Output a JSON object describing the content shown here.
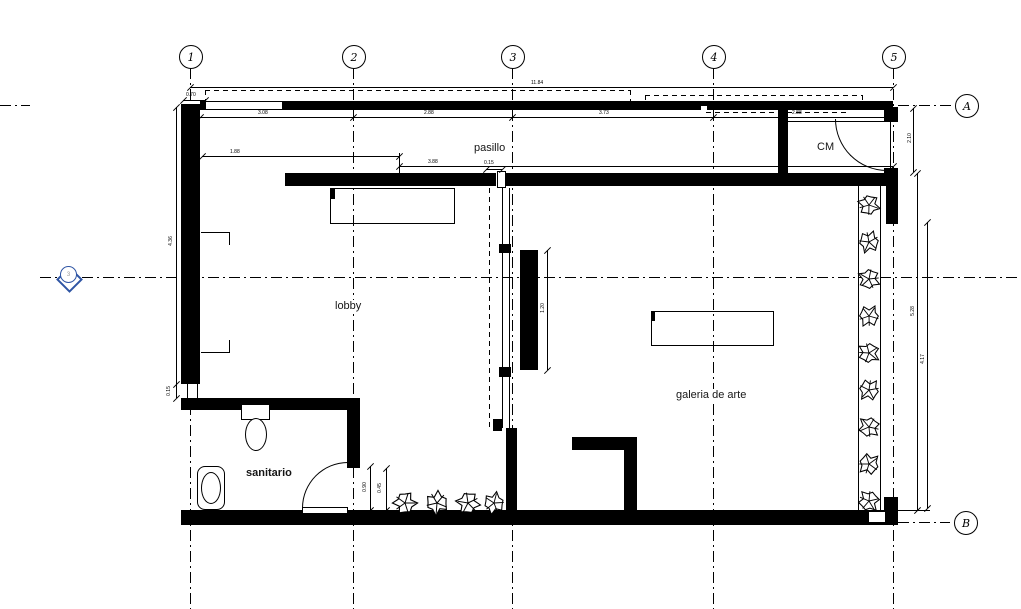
{
  "title": "floor plan",
  "rooms": {
    "pasillo": "pasillo",
    "cm": "CM",
    "lobby": "lobby",
    "galeria": "galeria de arte",
    "sanitario": "sanitario"
  },
  "grid": {
    "columns": [
      "1",
      "2",
      "3",
      "4",
      "5"
    ],
    "rows": [
      "A",
      "B"
    ],
    "section_marker": "3"
  },
  "dims": {
    "overall": "11.84",
    "seg12": "3.08",
    "seg23": "2.88",
    "seg34": "3.73",
    "seg45": "2.88",
    "wall_offset": "0.70",
    "pasillo_left": "1.88",
    "pasillo_right": "3.88",
    "partition_gap": "0.15",
    "left_height": "4.36",
    "left_small": "0.15",
    "cm_side": "2.10",
    "right_a": "5.28",
    "right_b": "4.17",
    "panel": "1.20",
    "planter": "0.45",
    "door": "0.90"
  },
  "colors": {
    "line": "#000000",
    "marker_blue": "#2f55a4"
  }
}
